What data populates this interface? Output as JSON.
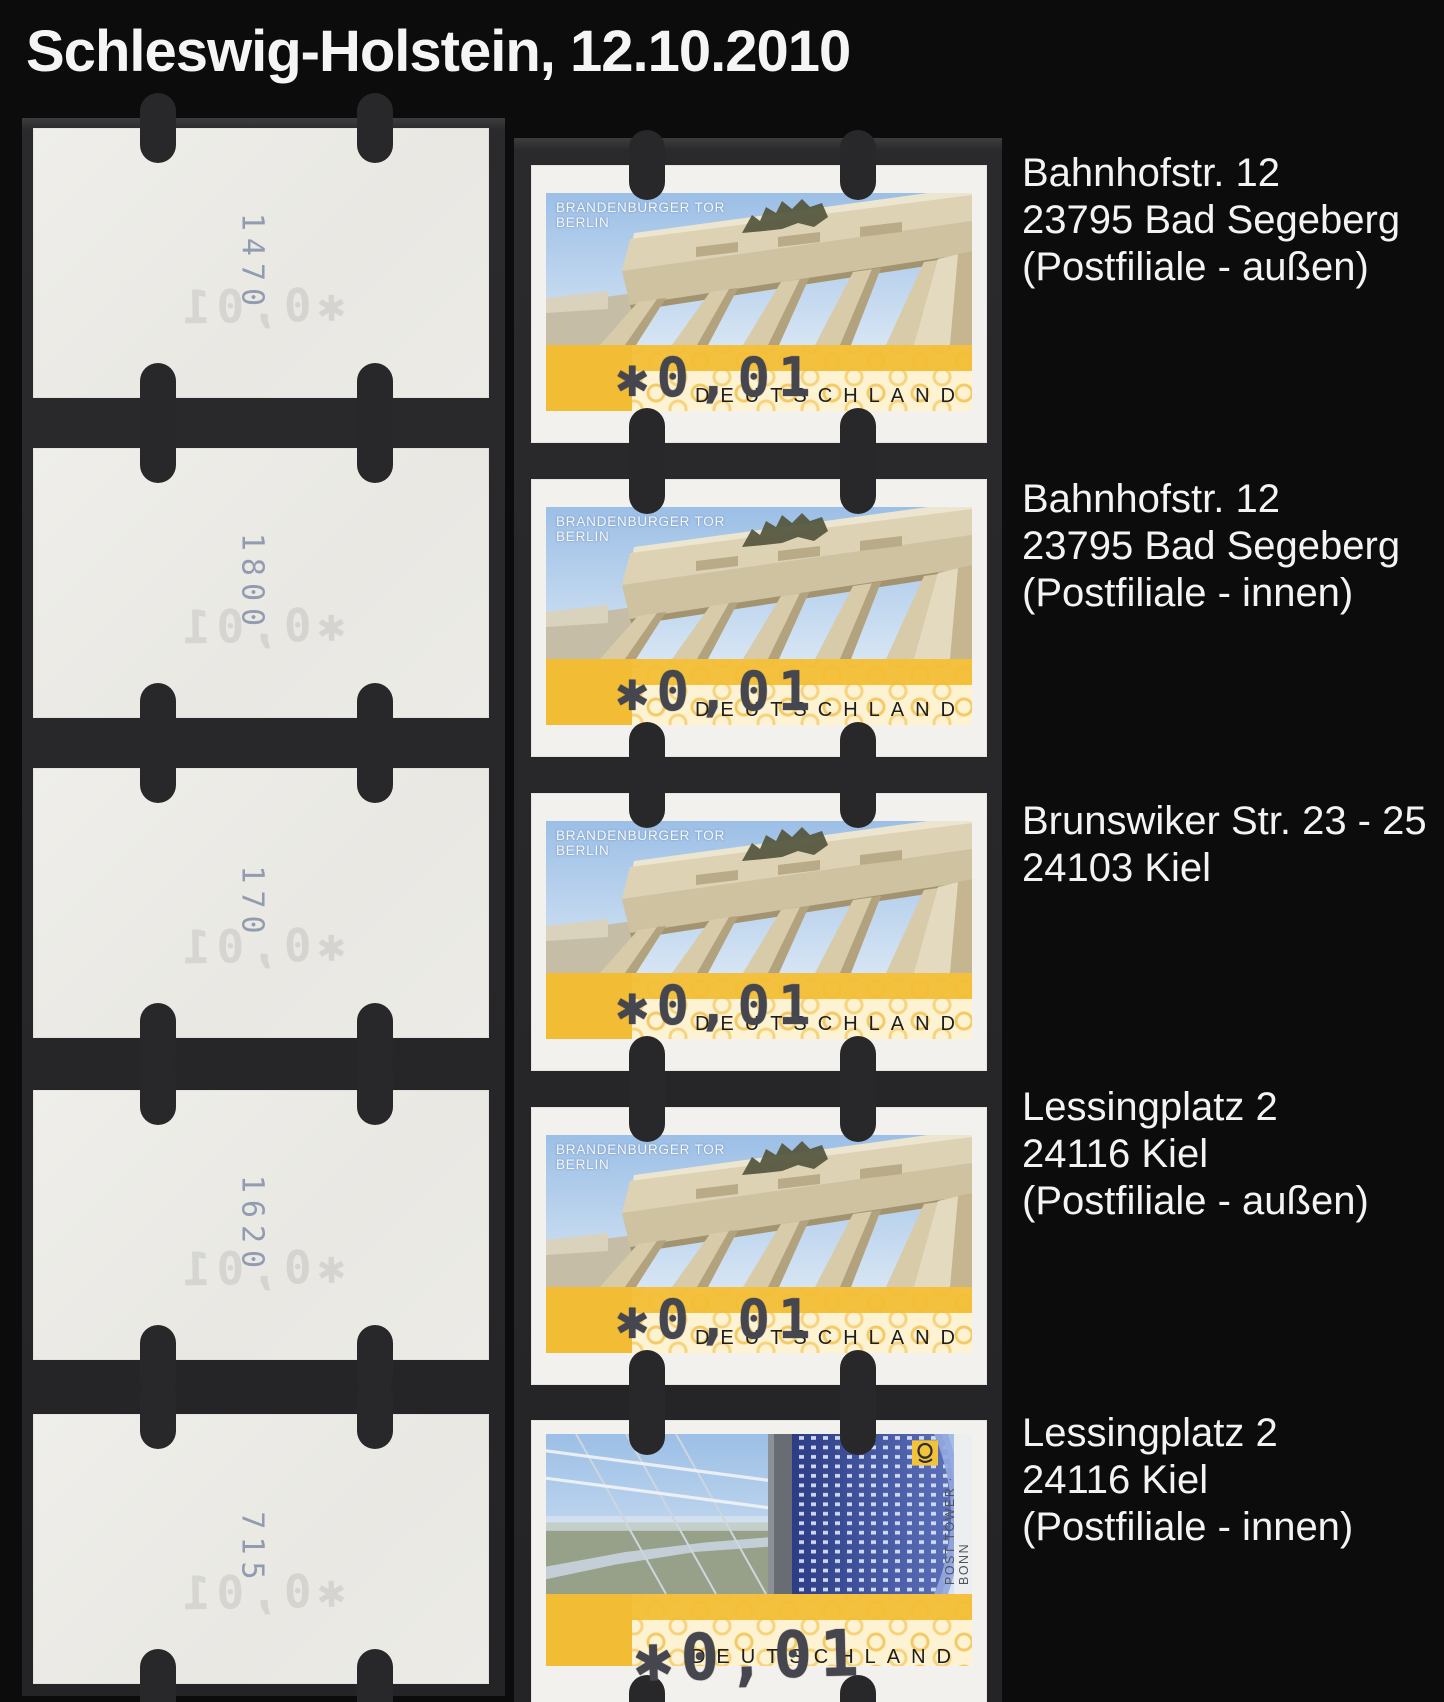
{
  "title": "Schleswig-Holstein, 12.10.2010",
  "stamp_common": {
    "machine_value": "✱0,01",
    "country": "DEUTSCHLAND",
    "brandenburg_motif": {
      "line1": "BRANDENBURGER TOR",
      "line2": "BERLIN"
    },
    "posttower_motif": {
      "side_text": "POST TOWER · BONN"
    }
  },
  "rows": [
    {
      "back_number": "1470",
      "stamp": "brandenburger-tor",
      "label_lines": [
        "Bahnhofstr. 12",
        "23795 Bad Segeberg",
        "(Postfiliale - außen)"
      ]
    },
    {
      "back_number": "1800",
      "stamp": "brandenburger-tor",
      "label_lines": [
        "Bahnhofstr. 12",
        "23795 Bad Segeberg",
        "(Postfiliale - innen)"
      ]
    },
    {
      "back_number": "170",
      "stamp": "brandenburger-tor",
      "label_lines": [
        "Brunswiker Str. 23 - 25",
        "24103 Kiel"
      ]
    },
    {
      "back_number": "1620",
      "stamp": "brandenburger-tor",
      "label_lines": [
        "Lessingplatz 2",
        "24116 Kiel",
        "(Postfiliale - außen)"
      ]
    },
    {
      "back_number": "715",
      "stamp": "post-tower-bonn",
      "label_lines": [
        "Lessingplatz 2",
        "24116 Kiel",
        "(Postfiliale - innen)"
      ]
    }
  ],
  "colors": {
    "background": "#0c0c0c",
    "backing_strip": "#28282a",
    "stamp_paper": "#f1f0ec",
    "band_yellow": "#f2bc35",
    "band_cream": "#fdf3d2",
    "machine_print_ink": "#46464f",
    "label_text": "#f3f3f3",
    "back_number_ink": "#7d88a4",
    "sky_blue": "#9cbfe6",
    "tower_blue": "#3c4f9c"
  }
}
